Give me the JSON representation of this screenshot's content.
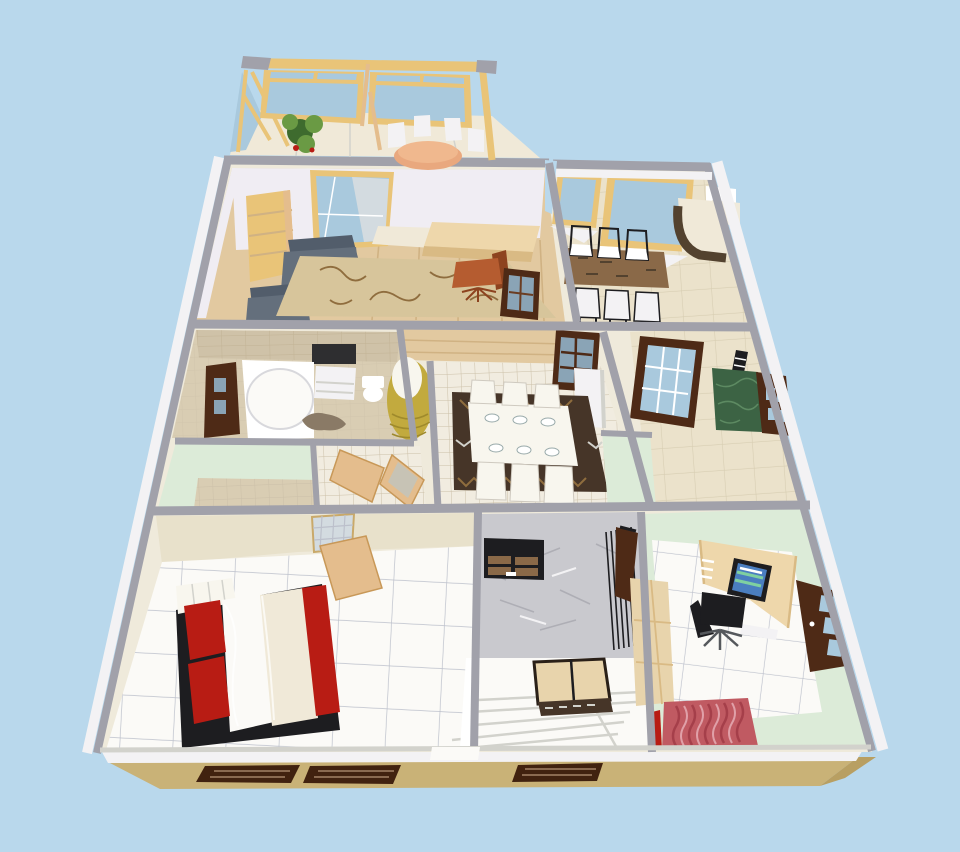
{
  "scene": {
    "title": "3D aerial dollhouse render of a single-story home floor plan",
    "background": "sky blue"
  },
  "rooms": [
    {
      "id": "sunroom",
      "label": "Sunroom balcony with round table"
    },
    {
      "id": "living-room",
      "label": "Living room with gray armchairs and rug"
    },
    {
      "id": "dining-room",
      "label": "Dining room with wooden table and six chairs"
    },
    {
      "id": "bathroom",
      "label": "Bathroom with corner tub"
    },
    {
      "id": "hallway",
      "label": "Center hallway with gold floor lamp"
    },
    {
      "id": "kitchen-dining",
      "label": "Kitchen dining room with white table set"
    },
    {
      "id": "utility-room",
      "label": "Utility room with green marble counter"
    },
    {
      "id": "bedroom",
      "label": "Bedroom with red and white bed"
    },
    {
      "id": "entry-hall",
      "label": "Entry hall with bench and stairs"
    },
    {
      "id": "home-office",
      "label": "Home office with desk and computer"
    }
  ],
  "colors": {
    "sky": "#b9d8ec",
    "wallGray": "#a1a1aa",
    "wallWhite": "#f3f2f4",
    "offWhite": "#efeadb",
    "lavender": "#f0edf3",
    "mint": "#dcebd8",
    "beigeTile": "#ebe2cb",
    "tileLine": "#d7cdb2",
    "bathTan": "#d9cdb3",
    "brickTan": "#cfc2a8",
    "brickLine": "#c2b395",
    "woodFloor": "#e2c9a0",
    "plankLine": "#d0b283",
    "woodFrame": "#e9c478",
    "woodLight": "#e4bd8d",
    "glass": "#a9c9dd",
    "glassDark": "#8aa4b6",
    "curtain": "#d3dbe0",
    "doorBrown": "#4e2a16",
    "doorEdge": "#6b3d22",
    "sofaGray": "#646f7c",
    "sofaDark": "#525d6b",
    "sofaLight": "#78828f",
    "rugTan": "#d7c59b",
    "rugPat": "#8f6d3e",
    "rugDark": "#463528",
    "tableBrown": "#8a6948",
    "cream": "#f0e9d8",
    "creamWall": "#e8e1cb",
    "granite": "#53422f",
    "gold": "#c2aa3e",
    "goldDark": "#9f8a2c",
    "glow": "#f8f6ee",
    "marble": "#c9c9ce",
    "marbleVein": "#aeaeb5",
    "bench": "#e8d4ac",
    "deskWood": "#eed7ab",
    "deskEdge": "#d9ba84",
    "screenBlue": "#4a7ec0",
    "screenStripe": "#7fd0a0",
    "red": "#b81c14",
    "redRug": "#c05a62",
    "redRugDark": "#a53f4a",
    "tanBase": "#c9b277",
    "tanBaseDark": "#b89f62",
    "windowDark": "#41220f",
    "windowSlat": "#8a6a50",
    "black": "#1d1d20",
    "chairBrown": "#b55c30",
    "chairBrownDark": "#8d431f",
    "greenMarble": "#3c6344",
    "greenVein": "#5d8a62",
    "whiteTile": "#f1ece0",
    "gridLine": "#ccc0a8",
    "floorWhite": "#fbfaf7",
    "gridBlue": "#bcc0cb",
    "stepLine": "#d2d2cc",
    "plantGreen": "#6a9a44",
    "plantDark": "#3e6b2e",
    "peach": "#e9a87e",
    "mirror": "#2e2e30",
    "catBrown": "#8a7a66",
    "white": "#ffffff"
  }
}
